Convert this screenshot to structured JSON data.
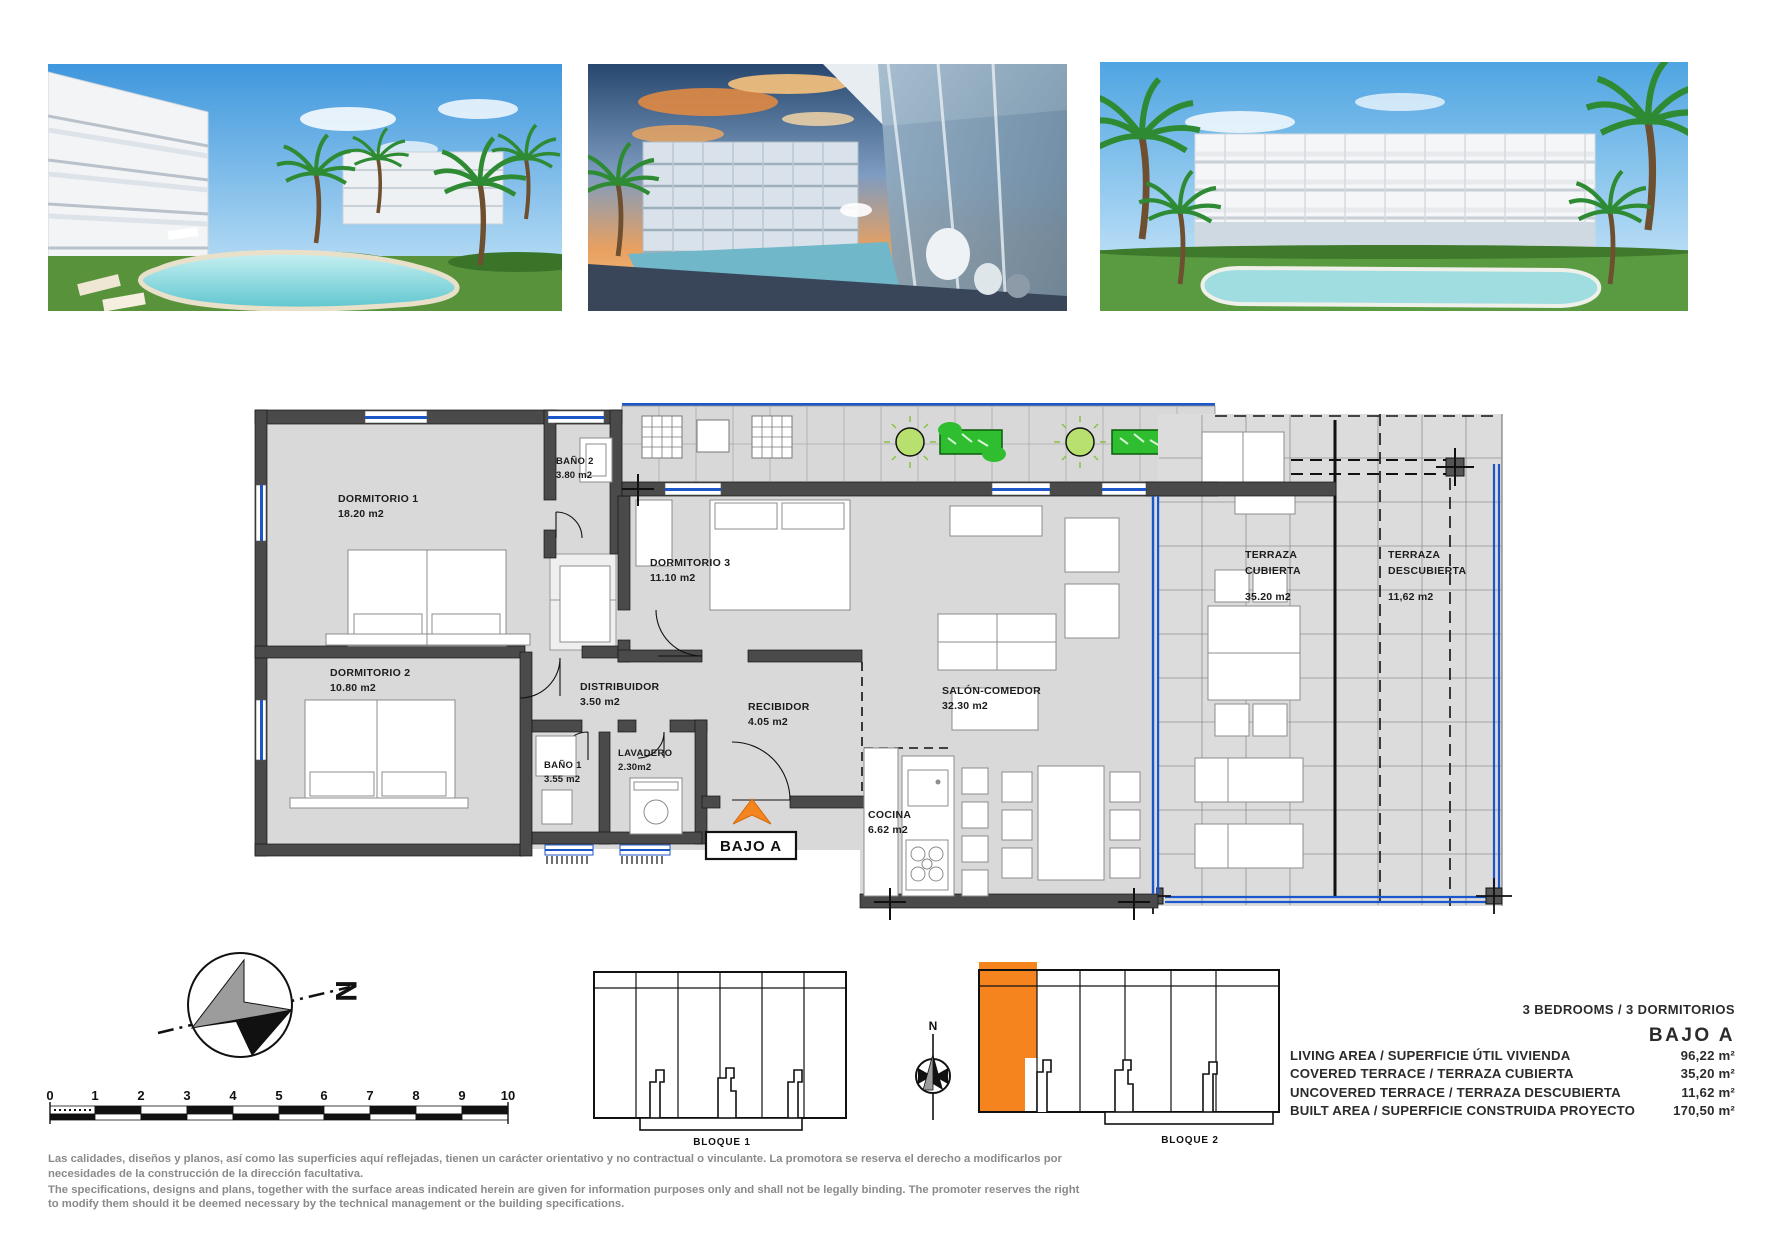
{
  "plan": {
    "unit_label": "BAJO A",
    "rooms": [
      {
        "name": "DORMITORIO 1",
        "area": "18.20 m2"
      },
      {
        "name": "BAÑO 2",
        "area": "3.80 m2"
      },
      {
        "name": "DORMITORIO 2",
        "area": "10.80 m2"
      },
      {
        "name": "DORMITORIO 3",
        "area": "11.10 m2"
      },
      {
        "name": "DISTRIBUIDOR",
        "area": "3.50 m2"
      },
      {
        "name": "RECIBIDOR",
        "area": "4.05 m2"
      },
      {
        "name": "BAÑO 1",
        "area": "3.55 m2"
      },
      {
        "name": "LAVADERO",
        "area": "2.30m2"
      },
      {
        "name": "SALÓN-COMEDOR",
        "area": "32.30 m2"
      },
      {
        "name": "COCINA",
        "area": "6.62 m2"
      },
      {
        "name": "TERRAZA",
        "name2": "CUBIERTA",
        "area": "35.20 m2"
      },
      {
        "name": "TERRAZA",
        "name2": "DESCUBIERTA",
        "area": "11,62 m2"
      }
    ],
    "colors": {
      "wall": "#4a4a4a",
      "floor": "#d9d9d9",
      "window_blue": "#1d56c8",
      "plant_green": "#2fbe2f",
      "accent_orange": "#f5841e"
    }
  },
  "compass": {
    "north_label": "N"
  },
  "scale_bar": {
    "ticks": [
      "0",
      "1",
      "2",
      "3",
      "4",
      "5",
      "6",
      "7",
      "8",
      "9",
      "10"
    ]
  },
  "blocks": {
    "block1_label": "BLOQUE 1",
    "block2_label": "BLOQUE 2",
    "small_compass_label": "N"
  },
  "specs": {
    "bedrooms_header": "3 BEDROOMS / 3 DORMITORIOS",
    "unit_title": "BAJO A",
    "rows": [
      {
        "label": "LIVING AREA / SUPERFICIE ÚTIL VIVIENDA",
        "value": "96,22 m²"
      },
      {
        "label": "COVERED TERRACE / TERRAZA CUBIERTA",
        "value": "35,20 m²"
      },
      {
        "label": "UNCOVERED TERRACE / TERRAZA DESCUBIERTA",
        "value": "11,62 m²"
      },
      {
        "label": "BUILT AREA / SUPERFICIE CONSTRUIDA PROYECTO",
        "value": "170,50 m²"
      }
    ]
  },
  "disclaimer": {
    "es": "Las calidades, diseños y planos, así como las superficies aquí reflejadas, tienen un carácter orientativo y no contractual o vinculante. La promotora se reserva el derecho a modificarlos por necesidades de la construcción de la dirección facultativa.",
    "en": "The specifications, designs and plans, together with the surface areas indicated herein are given for information purposes only and shall not be legally binding. The promoter reserves the right to modify them should it be deemed necessary by the technical management or the building specifications."
  }
}
